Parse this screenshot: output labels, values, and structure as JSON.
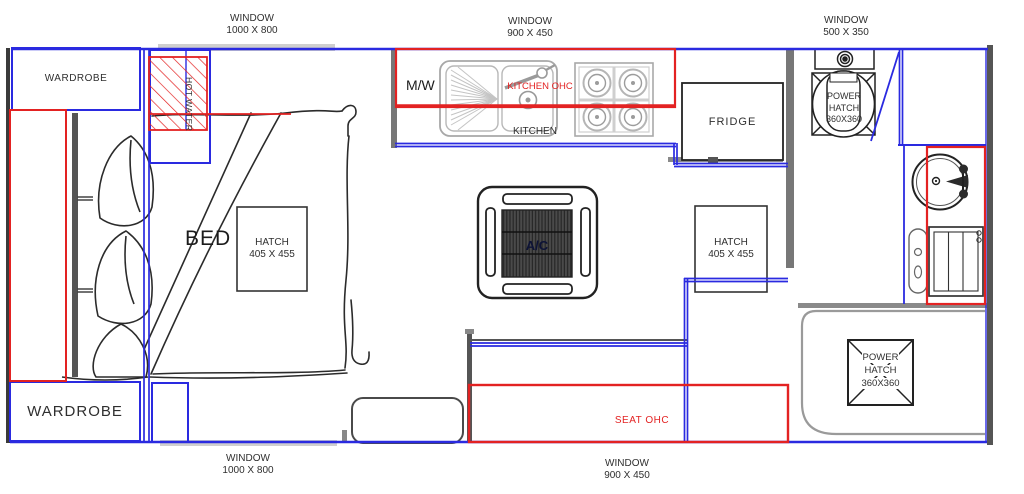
{
  "title": "Caravan floor plan",
  "colors": {
    "window_line_blue": "#2a2ae0",
    "ohc_red": "#e32222",
    "wall_gray": "#6b6b6b",
    "window_strip_gray": "#cfcfcf",
    "sketch_black": "#2b2b2b"
  },
  "windows": {
    "top_left": {
      "name": "WINDOW",
      "size": "1000 X 800"
    },
    "top_center": {
      "name": "WINDOW",
      "size": "900 X 450"
    },
    "top_right": {
      "name": "WINDOW",
      "size": "500 X 350"
    },
    "bottom_left": {
      "name": "WINDOW",
      "size": "1000 X 800"
    },
    "bottom_center": {
      "name": "WINDOW",
      "size": "900 X 450"
    }
  },
  "furniture": {
    "wardrobe_top": "WARDROBE",
    "wardrobe_bottom": "WARDROBE",
    "hot_water": "HOT WATER",
    "bed": "BED",
    "bed_hatch": {
      "line1": "HATCH",
      "line2": "405 X 455"
    },
    "mid_hatch": {
      "line1": "HATCH",
      "line2": "405 X 455"
    },
    "microwave": "M/W",
    "kitchen_ohc": "KITCHEN OHC",
    "kitchen": "KITCHEN",
    "fridge": "FRIDGE",
    "ac": "A/C",
    "seat_ohc": "SEAT OHC",
    "toilet_power_hatch": {
      "line1": "POWER",
      "line2": "HATCH",
      "line3": "360X360"
    },
    "shower_power_hatch": {
      "line1": "POWER",
      "line2": "HATCH",
      "line3": "360X360"
    }
  }
}
